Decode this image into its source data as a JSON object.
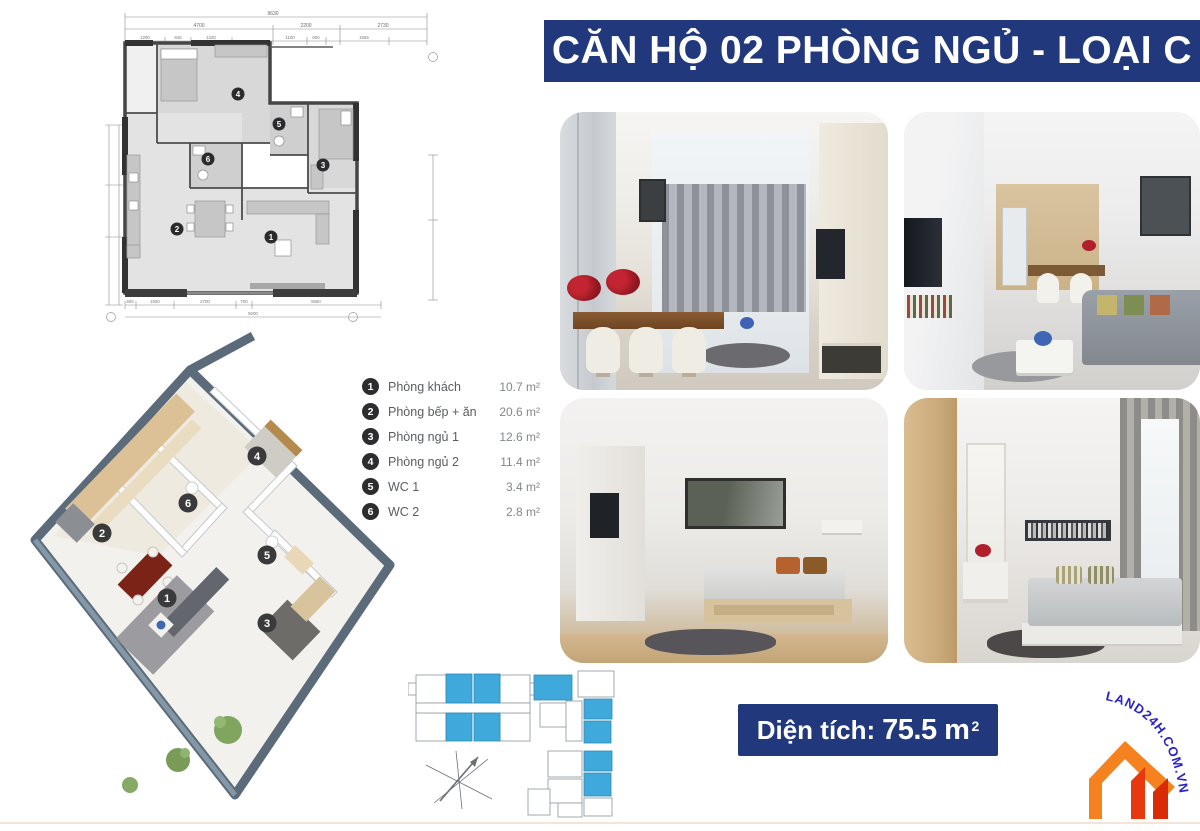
{
  "title": "CĂN HỘ 02 PHÒNG NGỦ - LOẠI C",
  "legend": {
    "items": [
      {
        "num": "1",
        "label": "Phòng khách",
        "area": "10.7 m²"
      },
      {
        "num": "2",
        "label": "Phòng bếp + ăn",
        "area": "20.6 m²"
      },
      {
        "num": "3",
        "label": "Phòng ngủ 1",
        "area": "12.6 m²"
      },
      {
        "num": "4",
        "label": "Phòng ngủ 2",
        "area": "11.4 m²"
      },
      {
        "num": "5",
        "label": "WC 1",
        "area": "3.4 m²"
      },
      {
        "num": "6",
        "label": "WC 2",
        "area": "2.8 m²"
      }
    ]
  },
  "area_banner": {
    "label": "Diện tích:",
    "value": "75.5 m",
    "sup": "2"
  },
  "watermark": "LAND24H.COM.VN",
  "floorplan_2d": {
    "dims_top_total": "9630",
    "dims_top": [
      "4700",
      "2200",
      "2730"
    ],
    "dims_top_small": [
      "1290",
      "845",
      "1320",
      "1100",
      "600",
      "1565"
    ],
    "dims_bottom": [
      "500",
      "1650",
      "2700",
      "700",
      "5660"
    ],
    "dims_bottom_total": "9200"
  },
  "photos": [
    {
      "name": "dining-and-living-room"
    },
    {
      "name": "living-room-toward-kitchen"
    },
    {
      "name": "bedroom-1"
    },
    {
      "name": "bedroom-2"
    }
  ],
  "colors": {
    "banner_navy": "#21397c",
    "unit_blue": "#3fa9dc",
    "logo_orange": "#f5821f",
    "logo_red": "#e8380d",
    "badge_dark": "#2d2d2f"
  }
}
